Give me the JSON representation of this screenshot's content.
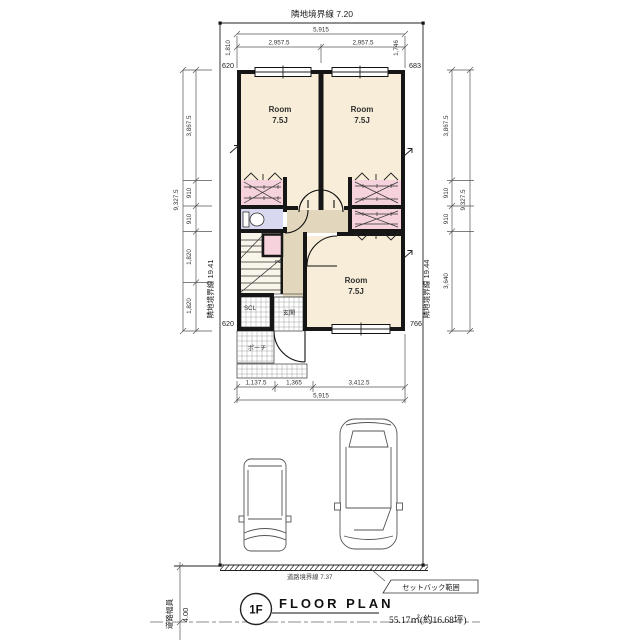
{
  "site": {
    "boundary_top": "隣地境界線 7.20",
    "boundary_left": "隣地境界線 19.41",
    "boundary_right": "隣地境界線 19.44",
    "boundary_road": "道路境界線 7.37",
    "setback_label": "セットバック範囲",
    "road_width_label": "道路幅員",
    "road_width_value": "4.00"
  },
  "dims": {
    "top": {
      "total": "5,915",
      "left_half": "2,957.5",
      "right_half": "2,957.5",
      "left_inset": "1,810",
      "right_inset": "1,746",
      "left_offset": "620",
      "right_offset": "683"
    },
    "left": {
      "total": "9,327.5",
      "seg1": "3,867.5",
      "seg2": "910",
      "seg3": "910",
      "seg4": "1,820",
      "seg5": "1,820",
      "bottom_offset": "620"
    },
    "right": {
      "total": "9,327.5",
      "seg1": "3,867.5",
      "seg2": "910",
      "seg3": "910",
      "seg4": "3,640",
      "bottom_offset": "766"
    },
    "bottom": {
      "seg1": "1,137.5",
      "seg2": "1,365",
      "seg3": "3,412.5",
      "total": "5,915"
    }
  },
  "rooms": {
    "room1": {
      "name": "Room",
      "size": "7.5J"
    },
    "room2": {
      "name": "Room",
      "size": "7.5J"
    },
    "room3": {
      "name": "Room",
      "size": "7.5J"
    },
    "entrance": "玄関",
    "porch": "ポーチ",
    "shoe_closet": "SCL",
    "pipe_space": "PS"
  },
  "title_block": {
    "floor": "1F",
    "title": "FLOOR PLAN",
    "area": "55.17㎡(約16.68坪)"
  },
  "colors": {
    "room": "#f7edd8",
    "closet": "#f6d2dc",
    "toilet": "#d8d8f0",
    "hall": "#e2d7bc",
    "stairs": "#faf5ea",
    "wall": "#161616"
  }
}
